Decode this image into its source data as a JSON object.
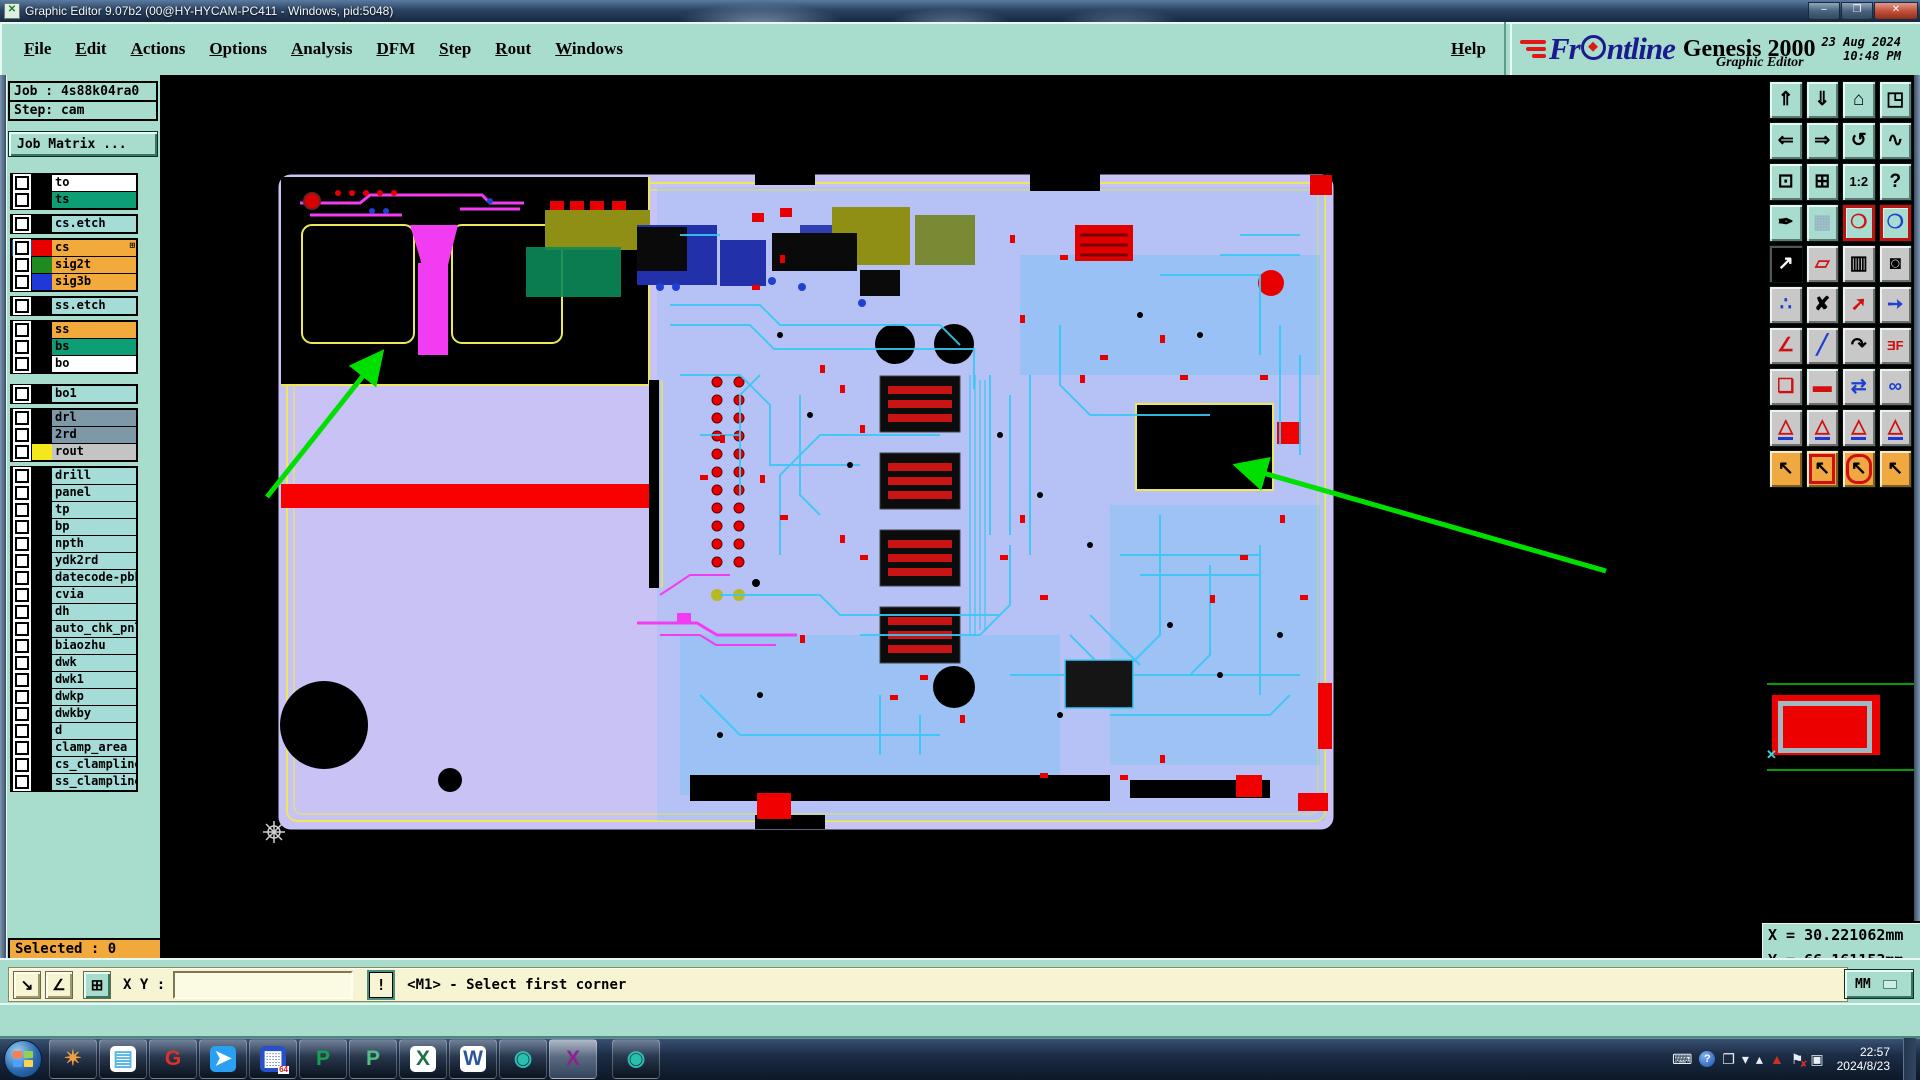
{
  "window": {
    "title": "Graphic Editor 9.07b2 (00@HY-HYCAM-PC411 - Windows, pid:5048)",
    "minimize_glyph": "–",
    "maximize_glyph": "❐",
    "close_glyph": "✕",
    "app_icon_glyph": "✕"
  },
  "menu": {
    "items": [
      {
        "label": "File"
      },
      {
        "label": "Edit"
      },
      {
        "label": "Actions"
      },
      {
        "label": "Options"
      },
      {
        "label": "Analysis"
      },
      {
        "label": "DFM"
      },
      {
        "label": "Step"
      },
      {
        "label": "Rout"
      },
      {
        "label": "Windows"
      }
    ],
    "help_label": "Help"
  },
  "brand": {
    "logo_pre": "Fr",
    "logo_post": "ntline",
    "product": "Genesis 2000",
    "subtitle": "Graphic Editor",
    "date": "23 Aug 2024",
    "time": "10:48 PM"
  },
  "sidebar": {
    "job_label": "Job : 4s88k04ra0",
    "step_label": "Step: cam",
    "job_matrix_label": "Job Matrix ...",
    "selected_label": "Selected : 0",
    "colors": {
      "orange": "#f2aa3c",
      "green": "#0d9e76",
      "cyan": "#a5dcd8",
      "slate": "#7e98a8",
      "gray": "#c4c4c4",
      "white": "#ffffff"
    },
    "layer_groups": [
      {
        "rows": [
          {
            "name": "to",
            "bg": "#ffffff"
          },
          {
            "name": "ts",
            "bg": "#0d9e76"
          }
        ]
      },
      {
        "rows": [
          {
            "name": "cs.etch",
            "bg": "#a5dcd8"
          }
        ]
      },
      {
        "rows": [
          {
            "name": "cs",
            "bg": "#f2aa3c",
            "swatch": "#e80000",
            "checkbox_bg": "#2040d0",
            "extra_icon": "⊞"
          },
          {
            "name": "sig2t",
            "bg": "#f2aa3c",
            "swatch": "#1f8a1f"
          },
          {
            "name": "sig3b",
            "bg": "#f2aa3c",
            "swatch": "#2038d8"
          }
        ]
      },
      {
        "rows": [
          {
            "name": "ss.etch",
            "bg": "#a5dcd8"
          }
        ]
      },
      {
        "rows": [
          {
            "name": "ss",
            "bg": "#f2aa3c"
          },
          {
            "name": "bs",
            "bg": "#0d9e76"
          },
          {
            "name": "bo",
            "bg": "#ffffff"
          }
        ]
      },
      {
        "biggap": true,
        "rows": [
          {
            "name": "bo1",
            "bg": "#a5dcd8"
          }
        ]
      },
      {
        "rows": [
          {
            "name": "drl",
            "bg": "#7e98a8"
          },
          {
            "name": "2rd",
            "bg": "#7e98a8"
          },
          {
            "name": "rout",
            "bg": "#c4c4c4",
            "swatch": "#f2e81c"
          }
        ]
      },
      {
        "rows": [
          {
            "name": "drill",
            "bg": "#a5dcd8"
          },
          {
            "name": "panel",
            "bg": "#a5dcd8"
          },
          {
            "name": "tp",
            "bg": "#a5dcd8"
          },
          {
            "name": "bp",
            "bg": "#a5dcd8"
          },
          {
            "name": "npth",
            "bg": "#a5dcd8"
          },
          {
            "name": "ydk2rd",
            "bg": "#a5dcd8"
          },
          {
            "name": "datecode-pbh",
            "bg": "#a5dcd8"
          },
          {
            "name": "cvia",
            "bg": "#a5dcd8"
          },
          {
            "name": "dh",
            "bg": "#a5dcd8"
          },
          {
            "name": "auto_chk_pnl",
            "bg": "#a5dcd8"
          },
          {
            "name": "biaozhu",
            "bg": "#a5dcd8"
          },
          {
            "name": "dwk",
            "bg": "#a5dcd8"
          },
          {
            "name": "dwk1",
            "bg": "#a5dcd8"
          },
          {
            "name": "dwkp",
            "bg": "#a5dcd8"
          },
          {
            "name": "dwkby",
            "bg": "#a5dcd8"
          },
          {
            "name": "d",
            "bg": "#a5dcd8"
          },
          {
            "name": "clamp_area",
            "bg": "#a5dcd8"
          },
          {
            "name": "cs_clampline",
            "bg": "#a5dcd8"
          },
          {
            "name": "ss_clampline",
            "bg": "#a5dcd8"
          }
        ]
      }
    ]
  },
  "right_toolbar": {
    "rows": [
      {
        "bg": "#a8dcce",
        "buttons": [
          {
            "name": "view-up-button",
            "glyph": "⇑",
            "fg": "#000000"
          },
          {
            "name": "view-down-button",
            "glyph": "⇓",
            "fg": "#000000"
          },
          {
            "name": "home-view-button",
            "glyph": "⌂",
            "fg": "#000000"
          },
          {
            "name": "split-window-xy-button",
            "glyph": "◳",
            "fg": "#000000"
          }
        ]
      },
      {
        "bg": "#a8dcce",
        "buttons": [
          {
            "name": "pan-left-button",
            "glyph": "⇐",
            "fg": "#000000"
          },
          {
            "name": "pan-right-button",
            "glyph": "⇒",
            "fg": "#000000"
          },
          {
            "name": "previous-view-button",
            "glyph": "↺",
            "fg": "#000000"
          },
          {
            "name": "serpentine-button",
            "glyph": "∿",
            "fg": "#000000"
          }
        ]
      },
      {
        "bg": "#a8dcce",
        "buttons": [
          {
            "name": "fit-view-button",
            "glyph": "⊡",
            "fg": "#000000"
          },
          {
            "name": "center-view-button",
            "glyph": "⊞",
            "fg": "#000000"
          },
          {
            "name": "zoom-1-2-button",
            "glyph": "1:2",
            "fg": "#000000",
            "small": true
          },
          {
            "name": "help-mode-button",
            "glyph": "?",
            "fg": "#000000"
          }
        ]
      },
      {
        "bg": "#a8dcce",
        "buttons": [
          {
            "name": "setup-tools-button",
            "glyph": "✒",
            "fg": "#000000"
          },
          {
            "name": "grid-button",
            "glyph": "▦",
            "fg": "#9ab8c4"
          },
          {
            "name": "highlight-net-a-button",
            "glyph": "❍",
            "fg": "#d01010",
            "frame": "border-red"
          },
          {
            "name": "highlight-net-b-button",
            "glyph": "❍",
            "fg": "#2040d0",
            "frame": "border-red"
          }
        ]
      },
      {
        "bg": "#c8c8c8",
        "buttons": [
          {
            "name": "invert-select-button",
            "glyph": "↗",
            "fg": "#ffffff",
            "frame": "inv"
          },
          {
            "name": "shape-select-button",
            "glyph": "▱",
            "fg": "#d01010"
          },
          {
            "name": "ruler-button",
            "glyph": "▥",
            "fg": "#000000"
          },
          {
            "name": "pad-select-button",
            "glyph": "◙",
            "fg": "#000000"
          }
        ]
      },
      {
        "bg": "#c8c8c8",
        "buttons": [
          {
            "name": "net-points-button",
            "glyph": "∴",
            "fg": "#2040d0"
          },
          {
            "name": "delete-button",
            "glyph": "✘",
            "fg": "#000000"
          },
          {
            "name": "copy-button",
            "glyph": "➚",
            "fg": "#d01010"
          },
          {
            "name": "move-button",
            "glyph": "➙",
            "fg": "#2040d0"
          }
        ]
      },
      {
        "bg": "#c8c8c8",
        "buttons": [
          {
            "name": "angle-measure-button",
            "glyph": "∠",
            "fg": "#d01010"
          },
          {
            "name": "line-draw-button",
            "glyph": "╱",
            "fg": "#2040d0"
          },
          {
            "name": "rotate-button",
            "glyph": "↷",
            "fg": "#000000"
          },
          {
            "name": "mirror-text-button",
            "glyph": "ƎF",
            "fg": "#d01010",
            "small": true
          }
        ]
      },
      {
        "bg": "#c8c8c8",
        "buttons": [
          {
            "name": "copy-to-layer-button",
            "glyph": "❏",
            "fg": "#d01010"
          },
          {
            "name": "stretch-line-button",
            "glyph": "▬",
            "fg": "#d01010"
          },
          {
            "name": "measure-width-button",
            "glyph": "⇄",
            "fg": "#2040d0"
          },
          {
            "name": "round-shapes-button",
            "glyph": "∞",
            "fg": "#2040d0"
          }
        ]
      },
      {
        "bg": "#c8c8c8",
        "buttons": [
          {
            "name": "surface-mode-1-button",
            "glyph": "△",
            "fg": "#d01010",
            "frame": "underline-blue"
          },
          {
            "name": "surface-mode-2-button",
            "glyph": "△",
            "fg": "#d01010",
            "frame": "underline-blue"
          },
          {
            "name": "surface-mode-3-button",
            "glyph": "△",
            "fg": "#d01010",
            "frame": "underline-blue"
          },
          {
            "name": "surface-mode-4-button",
            "glyph": "△",
            "fg": "#d01010",
            "frame": "underline-blue"
          }
        ]
      },
      {
        "bg": "#f0a840",
        "buttons": [
          {
            "name": "select-single-button",
            "glyph": "↖",
            "fg": "#000000"
          },
          {
            "name": "select-frame-button",
            "glyph": "↖",
            "fg": "#000000",
            "frame": "frame-red"
          },
          {
            "name": "select-polygon-button",
            "glyph": "↖",
            "fg": "#000000",
            "frame": "frame-red-round"
          },
          {
            "name": "select-net-button",
            "glyph": "↖",
            "fg": "#000000"
          }
        ]
      }
    ]
  },
  "coords": {
    "x_label": "X = 30.221062mm",
    "y_label": "Y = 66.161153mm"
  },
  "statusbar": {
    "diag_btn_glyph": "↘",
    "angle_btn_glyph": "∠",
    "grid_btn_glyph": "⊞",
    "xy_label": "X Y :",
    "input_value": "",
    "excl_glyph": "!",
    "prompt": "<M1> - Select first corner",
    "units_label": "MM"
  },
  "taskbar": {
    "apps": [
      {
        "name": "shell-icon",
        "glyph": "✴",
        "fg": "#f0a040"
      },
      {
        "name": "notepad-icon",
        "glyph": "▤",
        "fg": "#58b8e8",
        "bg": "#ffffff"
      },
      {
        "name": "g-app-icon",
        "glyph": "G",
        "fg": "#e03028"
      },
      {
        "name": "messenger-icon",
        "glyph": "➤",
        "fg": "#ffffff",
        "bg": "#2aa0f2"
      },
      {
        "name": "backup-floppy-icon",
        "glyph": "▦",
        "fg": "#ffffff",
        "bg": "#2850c8",
        "badge": "64"
      },
      {
        "name": "p-green-icon",
        "glyph": "P",
        "fg": "#18a050"
      },
      {
        "name": "p-lightgreen-icon",
        "glyph": "P",
        "fg": "#50c080"
      },
      {
        "name": "excel-icon",
        "glyph": "X",
        "fg": "#1e7145",
        "bg": "#ffffff"
      },
      {
        "name": "word-icon",
        "glyph": "W",
        "fg": "#2b579a",
        "bg": "#ffffff"
      },
      {
        "name": "genesis-disc-icon",
        "glyph": "◉",
        "fg": "#28c0b0"
      },
      {
        "name": "exceed-x-icon",
        "glyph": "X",
        "fg": "#902090",
        "active": true
      },
      {
        "name": "genesis-disc-2-icon",
        "glyph": "◉",
        "fg": "#28c0b0",
        "separated": true
      }
    ],
    "tray": [
      {
        "name": "keyboard-icon",
        "glyph": "⌨"
      },
      {
        "name": "help-circle-icon",
        "glyph": "?",
        "circle": true
      },
      {
        "name": "restore-window-icon",
        "glyph": "❐"
      },
      {
        "name": "chevron-down-icon",
        "glyph": "▾"
      },
      {
        "name": "show-hidden-icon",
        "glyph": "▴"
      },
      {
        "name": "gpu-triangle-icon",
        "glyph": "▲",
        "tri": true
      },
      {
        "name": "action-center-flag-icon",
        "glyph": "⚑",
        "flag": true
      },
      {
        "name": "network-icon",
        "glyph": "▣"
      }
    ],
    "clock_time": "22:57",
    "clock_date": "2024/8/23"
  }
}
